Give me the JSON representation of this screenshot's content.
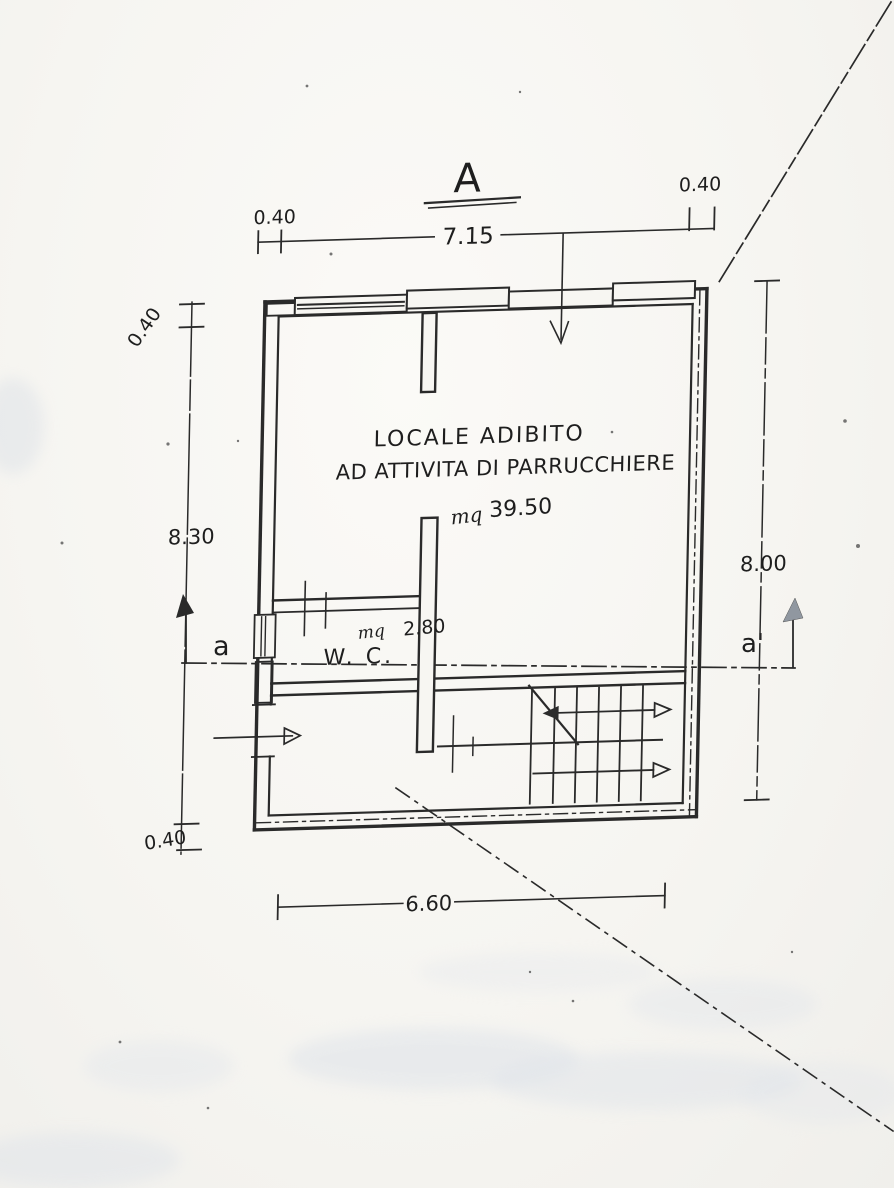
{
  "drawing": {
    "section_title": "A",
    "section_markers": {
      "left": "a",
      "right": "a'"
    },
    "main_room": {
      "label_line1": "LOCALE ADIBITO",
      "label_line2": "AD ATTIVITA DI PARRUCCHIERE",
      "area_unit": "mq",
      "area_value": "39.50"
    },
    "wc_room": {
      "label": "W. C.",
      "area_unit": "mq",
      "area_value": "2.80"
    },
    "dimensions": {
      "top_wall_left": "0.40",
      "top_span": "7.15",
      "top_wall_right": "0.40",
      "left_wall_top": "0.40",
      "left_span": "8.30",
      "left_wall_bottom": "0.40",
      "right_span": "8.00",
      "bottom_span": "6.60"
    },
    "ink_color": "#2a2a2a",
    "paper_color": "#f7f6f3"
  }
}
